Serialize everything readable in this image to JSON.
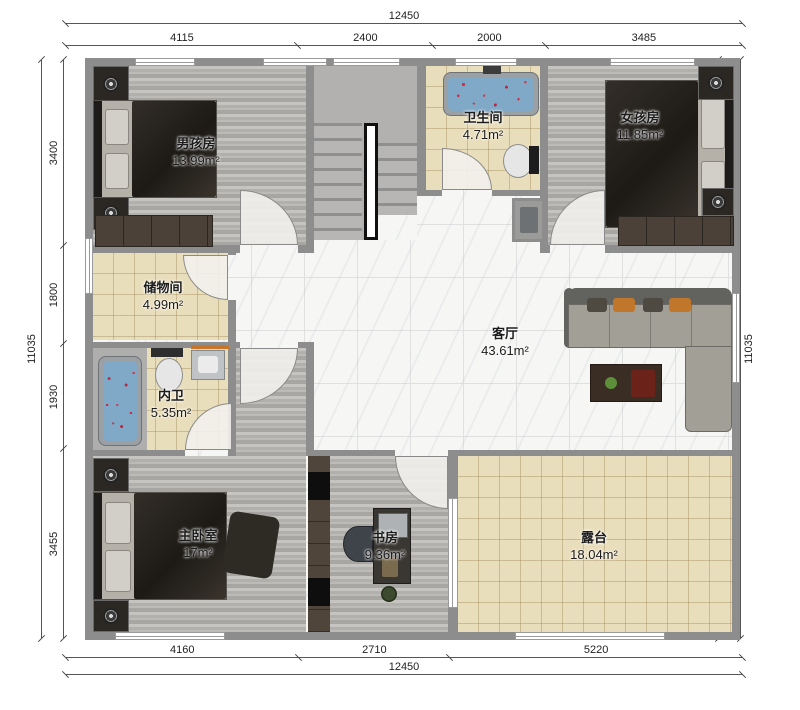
{
  "plan": {
    "dims": {
      "top_total": "12450",
      "top_segments": [
        "4115",
        "2400",
        "2000",
        "3485"
      ],
      "bottom_segments": [
        "4160",
        "2710",
        "5220"
      ],
      "bottom_total": "12450",
      "left_total": "11035",
      "left_segments": [
        "3400",
        "1800",
        "1930",
        "3455"
      ],
      "right_segments": [
        "3400",
        "3820",
        "3455"
      ],
      "right_total": "11035"
    },
    "rooms": {
      "boys": {
        "name": "男孩房",
        "area": "13.99m²"
      },
      "bath": {
        "name": "卫生间",
        "area": "4.71m²"
      },
      "girls": {
        "name": "女孩房",
        "area": "11.85m²"
      },
      "storage": {
        "name": "储物间",
        "area": "4.99m²"
      },
      "inner_bath": {
        "name": "内卫",
        "area": "5.35m²"
      },
      "living": {
        "name": "客厅",
        "area": "43.61m²"
      },
      "master": {
        "name": "主卧室",
        "area": "17m²"
      },
      "study": {
        "name": "书房",
        "area": "9.36m²"
      },
      "terrace": {
        "name": "露台",
        "area": "18.04m²"
      }
    },
    "colors": {
      "wall": "#8d8d8d",
      "wood_floor": "#b7b5b2",
      "tile_tan": "#e9debb",
      "marble": "#f6f6f5",
      "sofa_accent_orange": "#c0772c",
      "tub_blue": "#7fa9c7",
      "petal_red": "#c2304a"
    }
  }
}
